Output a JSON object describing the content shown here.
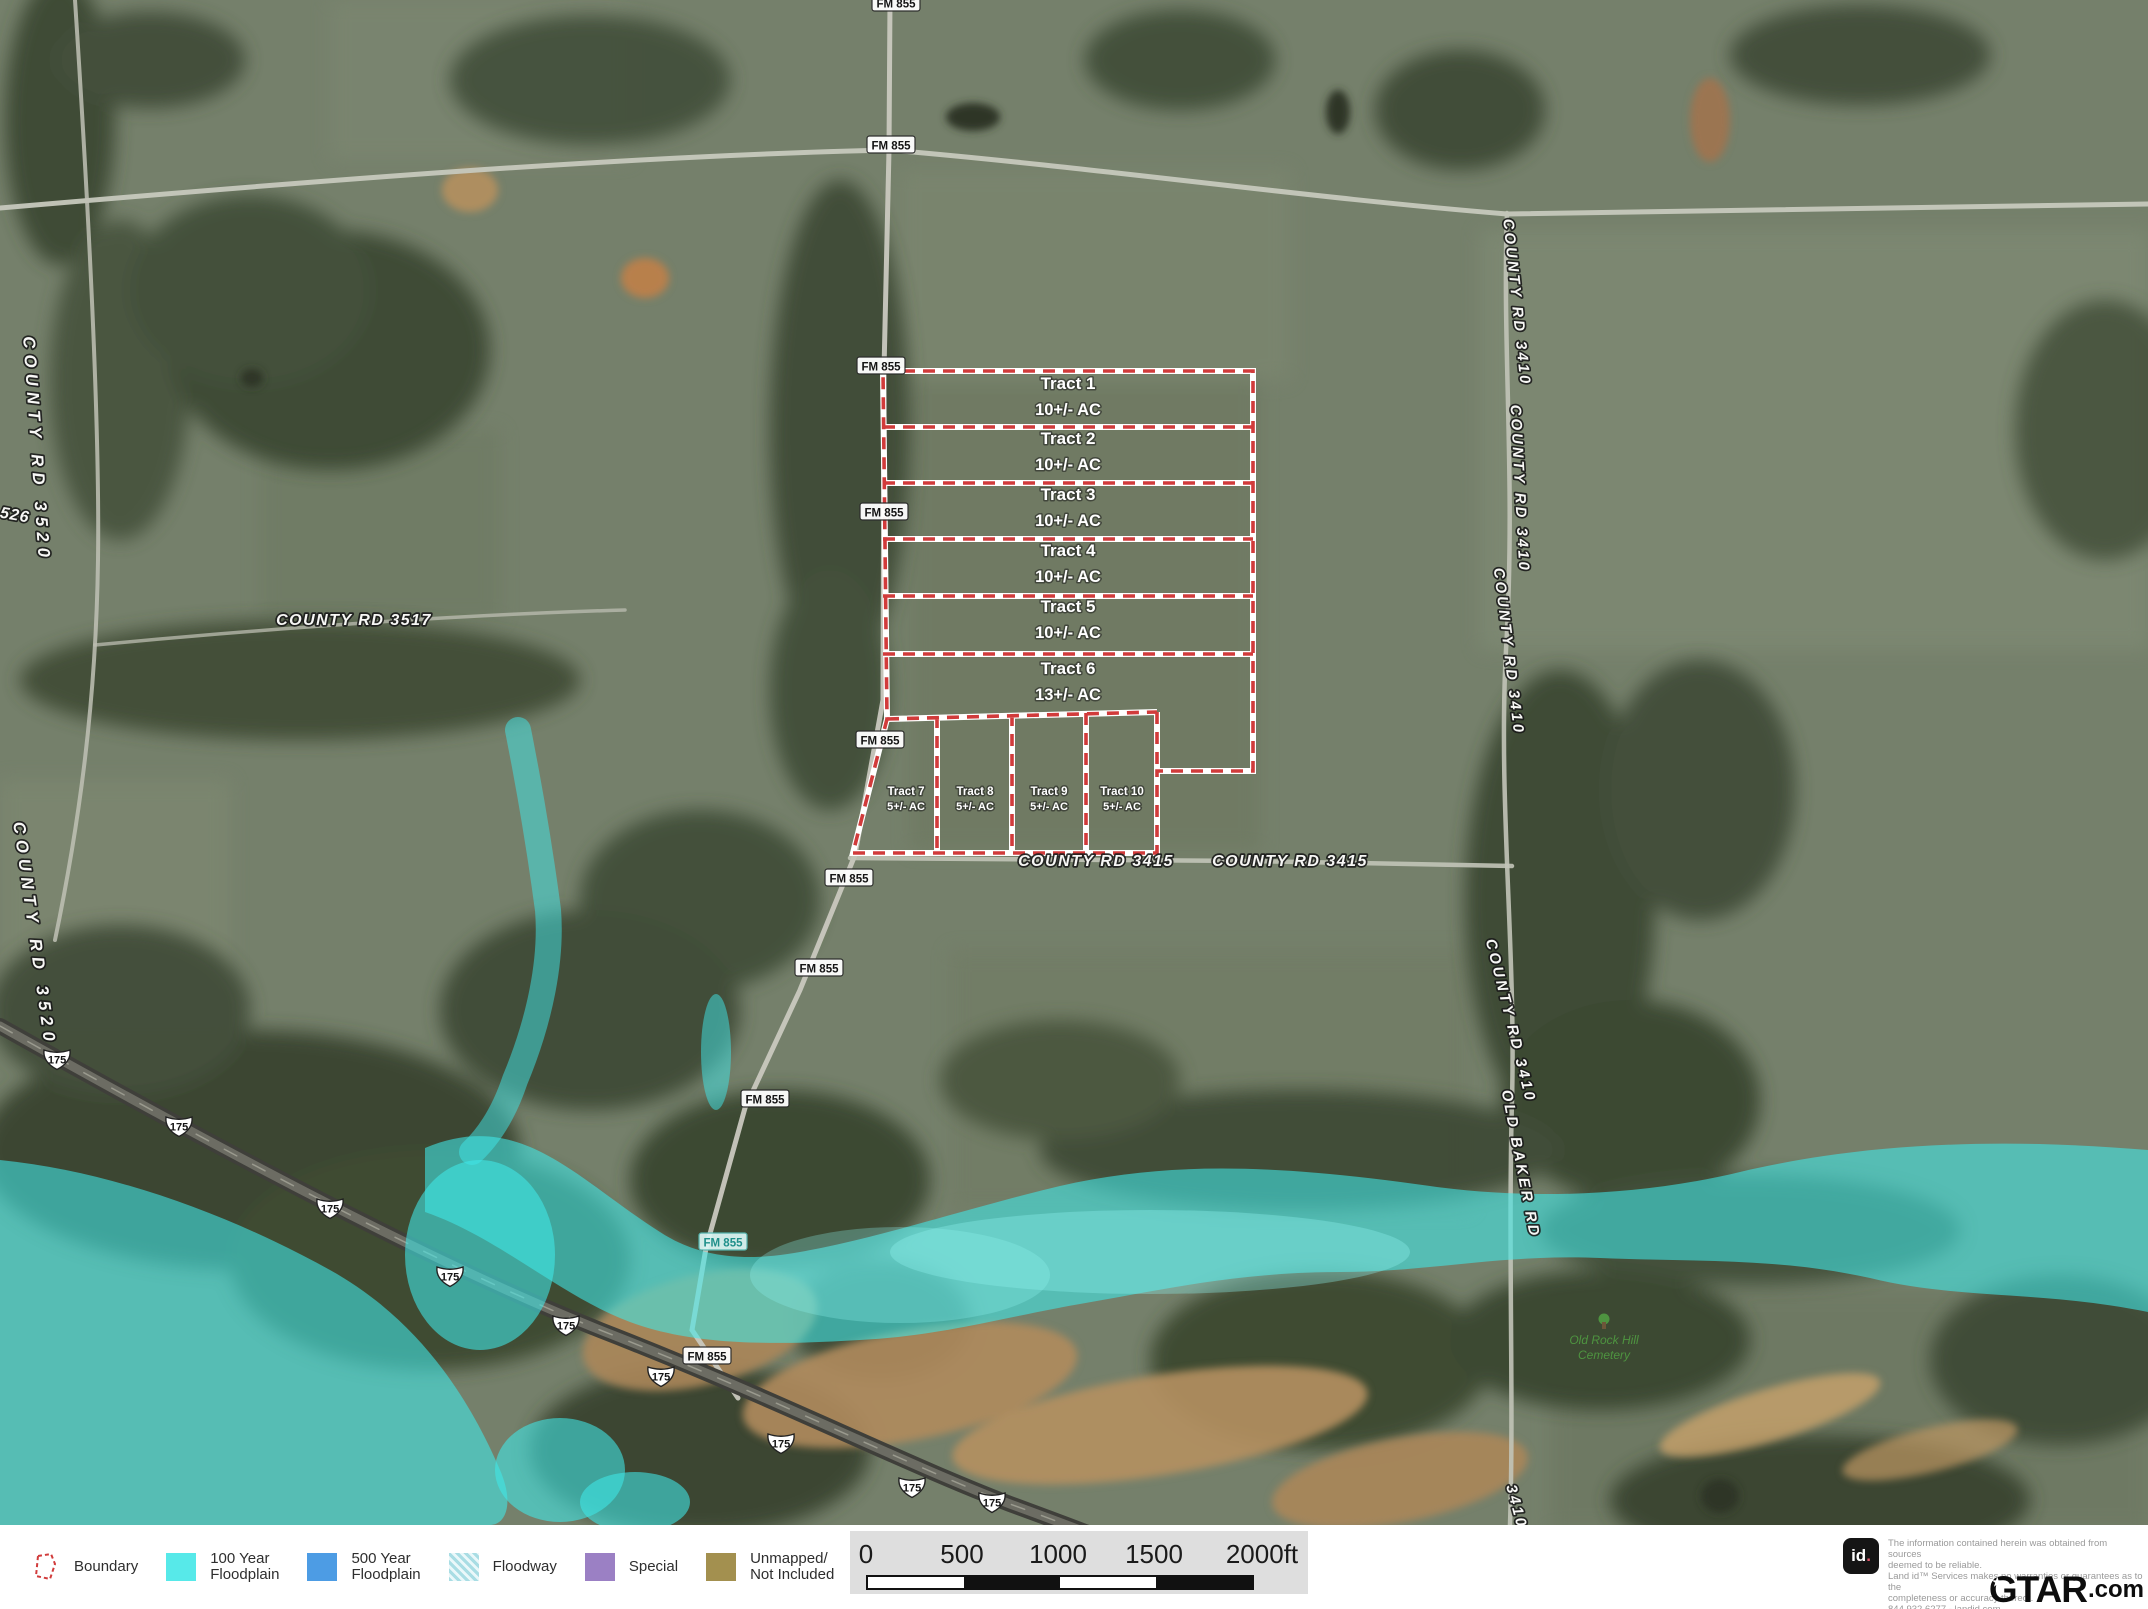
{
  "map": {
    "tracts": [
      {
        "name": "Tract 1",
        "acreage": "10+/- AC"
      },
      {
        "name": "Tract 2",
        "acreage": "10+/- AC"
      },
      {
        "name": "Tract 3",
        "acreage": "10+/- AC"
      },
      {
        "name": "Tract 4",
        "acreage": "10+/- AC"
      },
      {
        "name": "Tract 5",
        "acreage": "10+/- AC"
      },
      {
        "name": "Tract 6",
        "acreage": "13+/- AC"
      },
      {
        "name": "Tract 7",
        "acreage": "5+/- AC"
      },
      {
        "name": "Tract 8",
        "acreage": "5+/- AC"
      },
      {
        "name": "Tract 9",
        "acreage": "5+/- AC"
      },
      {
        "name": "Tract 10",
        "acreage": "5+/- AC"
      }
    ],
    "road_badges": {
      "fm855": "FM 855",
      "hwy175": "175"
    },
    "road_labels": {
      "cr3520": "COUNTY RD 3520",
      "cr3517": "COUNTY RD 3517",
      "cr3415": "COUNTY RD 3415",
      "cr3410": "COUNTY RD 3410",
      "cr526": "526",
      "old_baker": "OLD BAKER RD",
      "cr3410_part": "3410"
    },
    "cemetery": {
      "line1": "Old Rock Hill",
      "line2": "Cemetery"
    }
  },
  "colors": {
    "boundary_red": "#d13b3b",
    "floodplain_100": "#57e9e9",
    "floodplain_500": "#4d9ce4",
    "floodway": "#a9dde4",
    "special": "#9b80c4",
    "unmapped": "#a3904f"
  },
  "legend": {
    "items": [
      {
        "type": "boundary",
        "label1": "Boundary",
        "label2": ""
      },
      {
        "type": "flood100",
        "label1": "100 Year",
        "label2": "Floodplain"
      },
      {
        "type": "flood500",
        "label1": "500 Year",
        "label2": "Floodplain"
      },
      {
        "type": "floodway",
        "label1": "Floodway",
        "label2": ""
      },
      {
        "type": "special",
        "label1": "Special",
        "label2": ""
      },
      {
        "type": "unmapped",
        "label1": "Unmapped/",
        "label2": "Not Included"
      }
    ]
  },
  "scale": {
    "ticks": [
      "0",
      "500",
      "1000",
      "1500",
      "2000ft"
    ]
  },
  "attribution": {
    "logo_text": "id",
    "logo_dot": ".",
    "lines": [
      "The information contained herein was obtained from sources",
      "deemed to be reliable.",
      "Land id™ Services makes no warranties or guarantees as to the",
      "completeness or accuracy thereof.",
      "844.932.6277 - landid.com"
    ]
  },
  "watermark": {
    "brand": "GTAR",
    "suffix": ".com",
    "star": "★"
  }
}
